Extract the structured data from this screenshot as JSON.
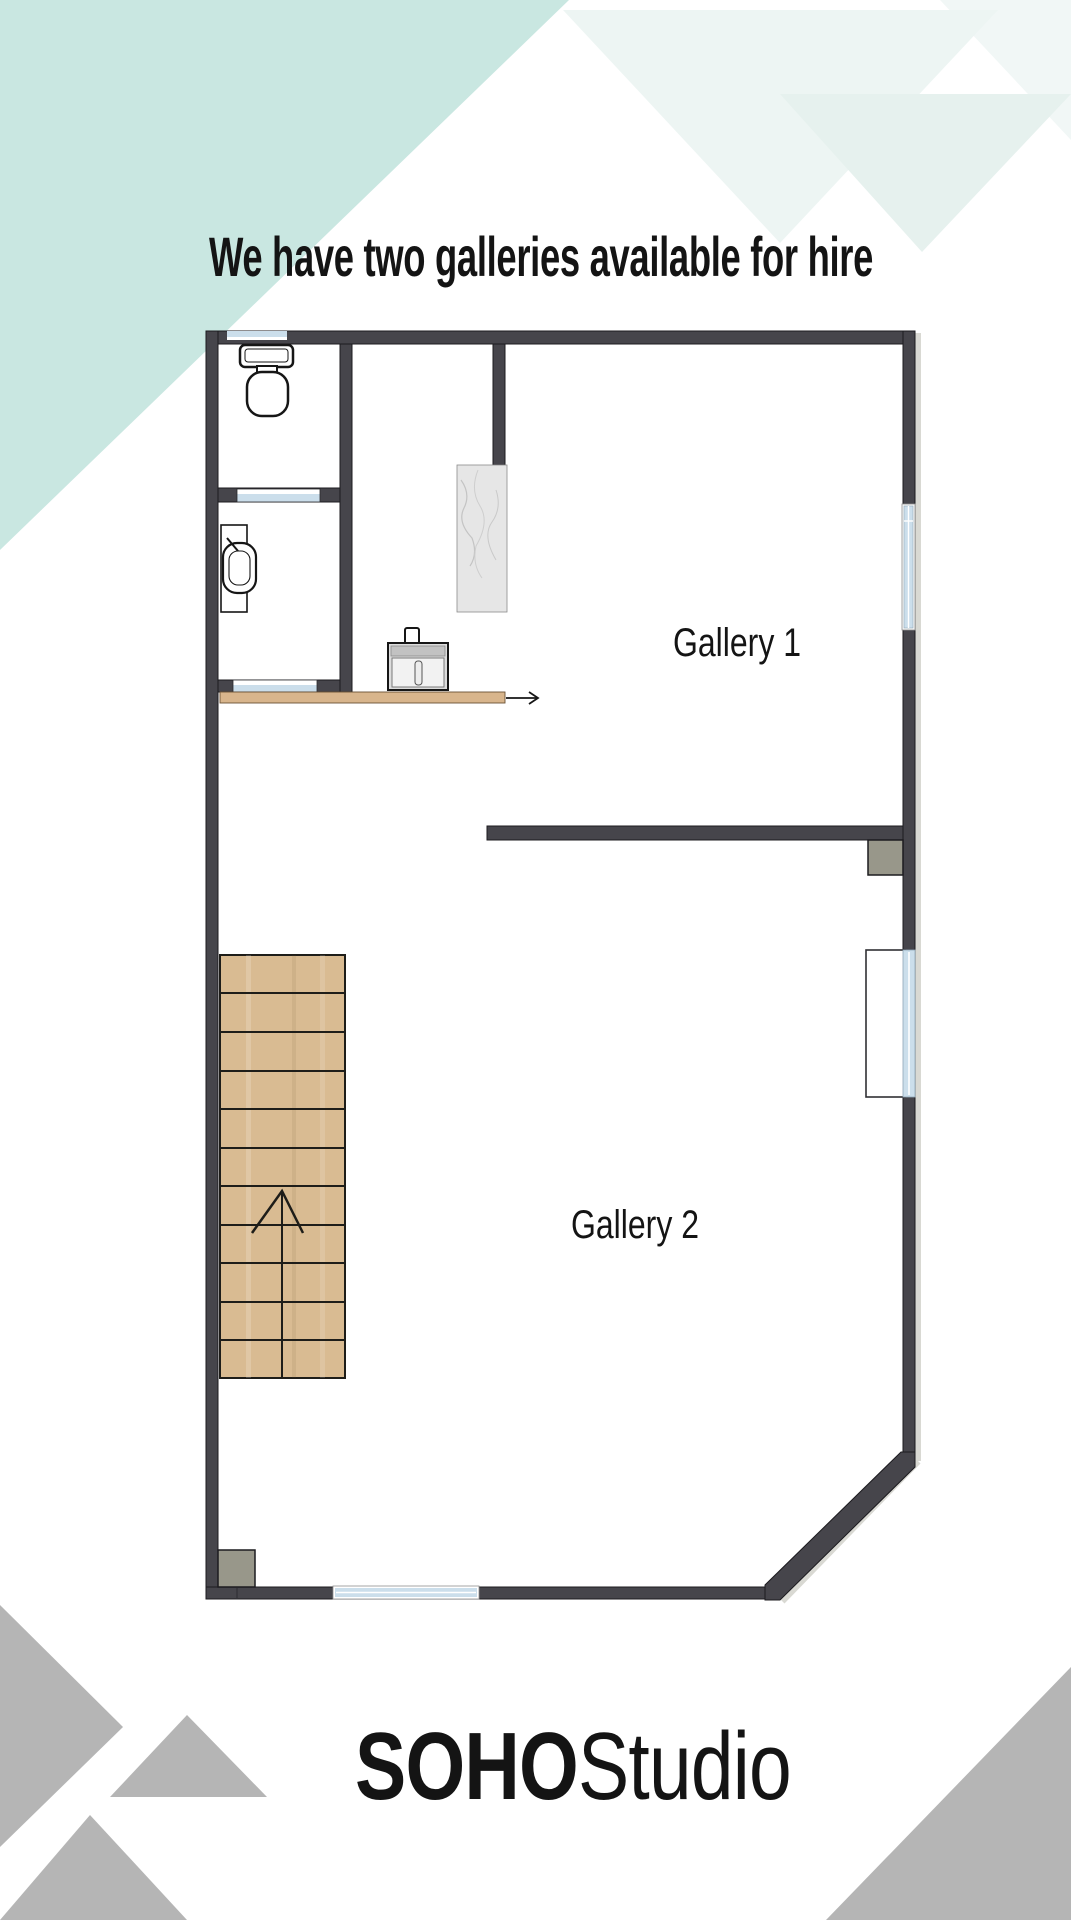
{
  "title": "We have two galleries available for hire",
  "floorplan": {
    "gallery1_label": "Gallery 1",
    "gallery2_label": "Gallery 2"
  },
  "logo": {
    "bold": "SOHO",
    "regular": "Studio"
  },
  "icons": {
    "stairs_direction": "up-arrow",
    "walkway_direction": "right-arrow"
  },
  "colors": {
    "wall": "#46454b",
    "wall-outline": "#1c1b1f",
    "mint": "#c9e7e1",
    "pale-mint": "#edf5f3",
    "pale-mint-2": "#e6f1ee",
    "pale-mint-3": "#f1f7f6",
    "gray-triangle": "#b5b5b5",
    "window-blue": "#cbdeeb",
    "wood": "#d9bb92",
    "counter-wood": "#d8b58c",
    "pillar": "#98978a",
    "marble": "#e6e6e6",
    "shadow": "#d9d9d3",
    "ink": "#141414"
  }
}
